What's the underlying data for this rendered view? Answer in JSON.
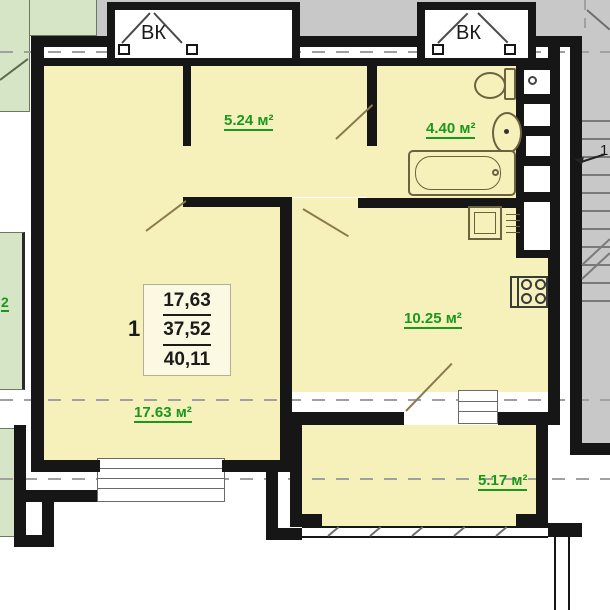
{
  "plan": {
    "vent_label_1": "ВК",
    "vent_label_2": "ВК",
    "stair_direction_mark": "1",
    "neighbor_area_partial": "2",
    "rooms": {
      "hall": "5.24 м²",
      "bathroom": "4.40 м²",
      "kitchen": "10.25 м²",
      "living": "17.63 м²",
      "balcony": "5.17 м²"
    },
    "area_table": {
      "apartment_number": "1",
      "living_area": "17,63",
      "total_area": "37,52",
      "overall_area": "40,11"
    },
    "colors": {
      "room_fill": "#f6f0ba",
      "neighbor_fill": "#d5e5c6",
      "wall": "#161616",
      "area_label_green": "#18991d",
      "corridor_gray": "#c8c8c8"
    }
  }
}
